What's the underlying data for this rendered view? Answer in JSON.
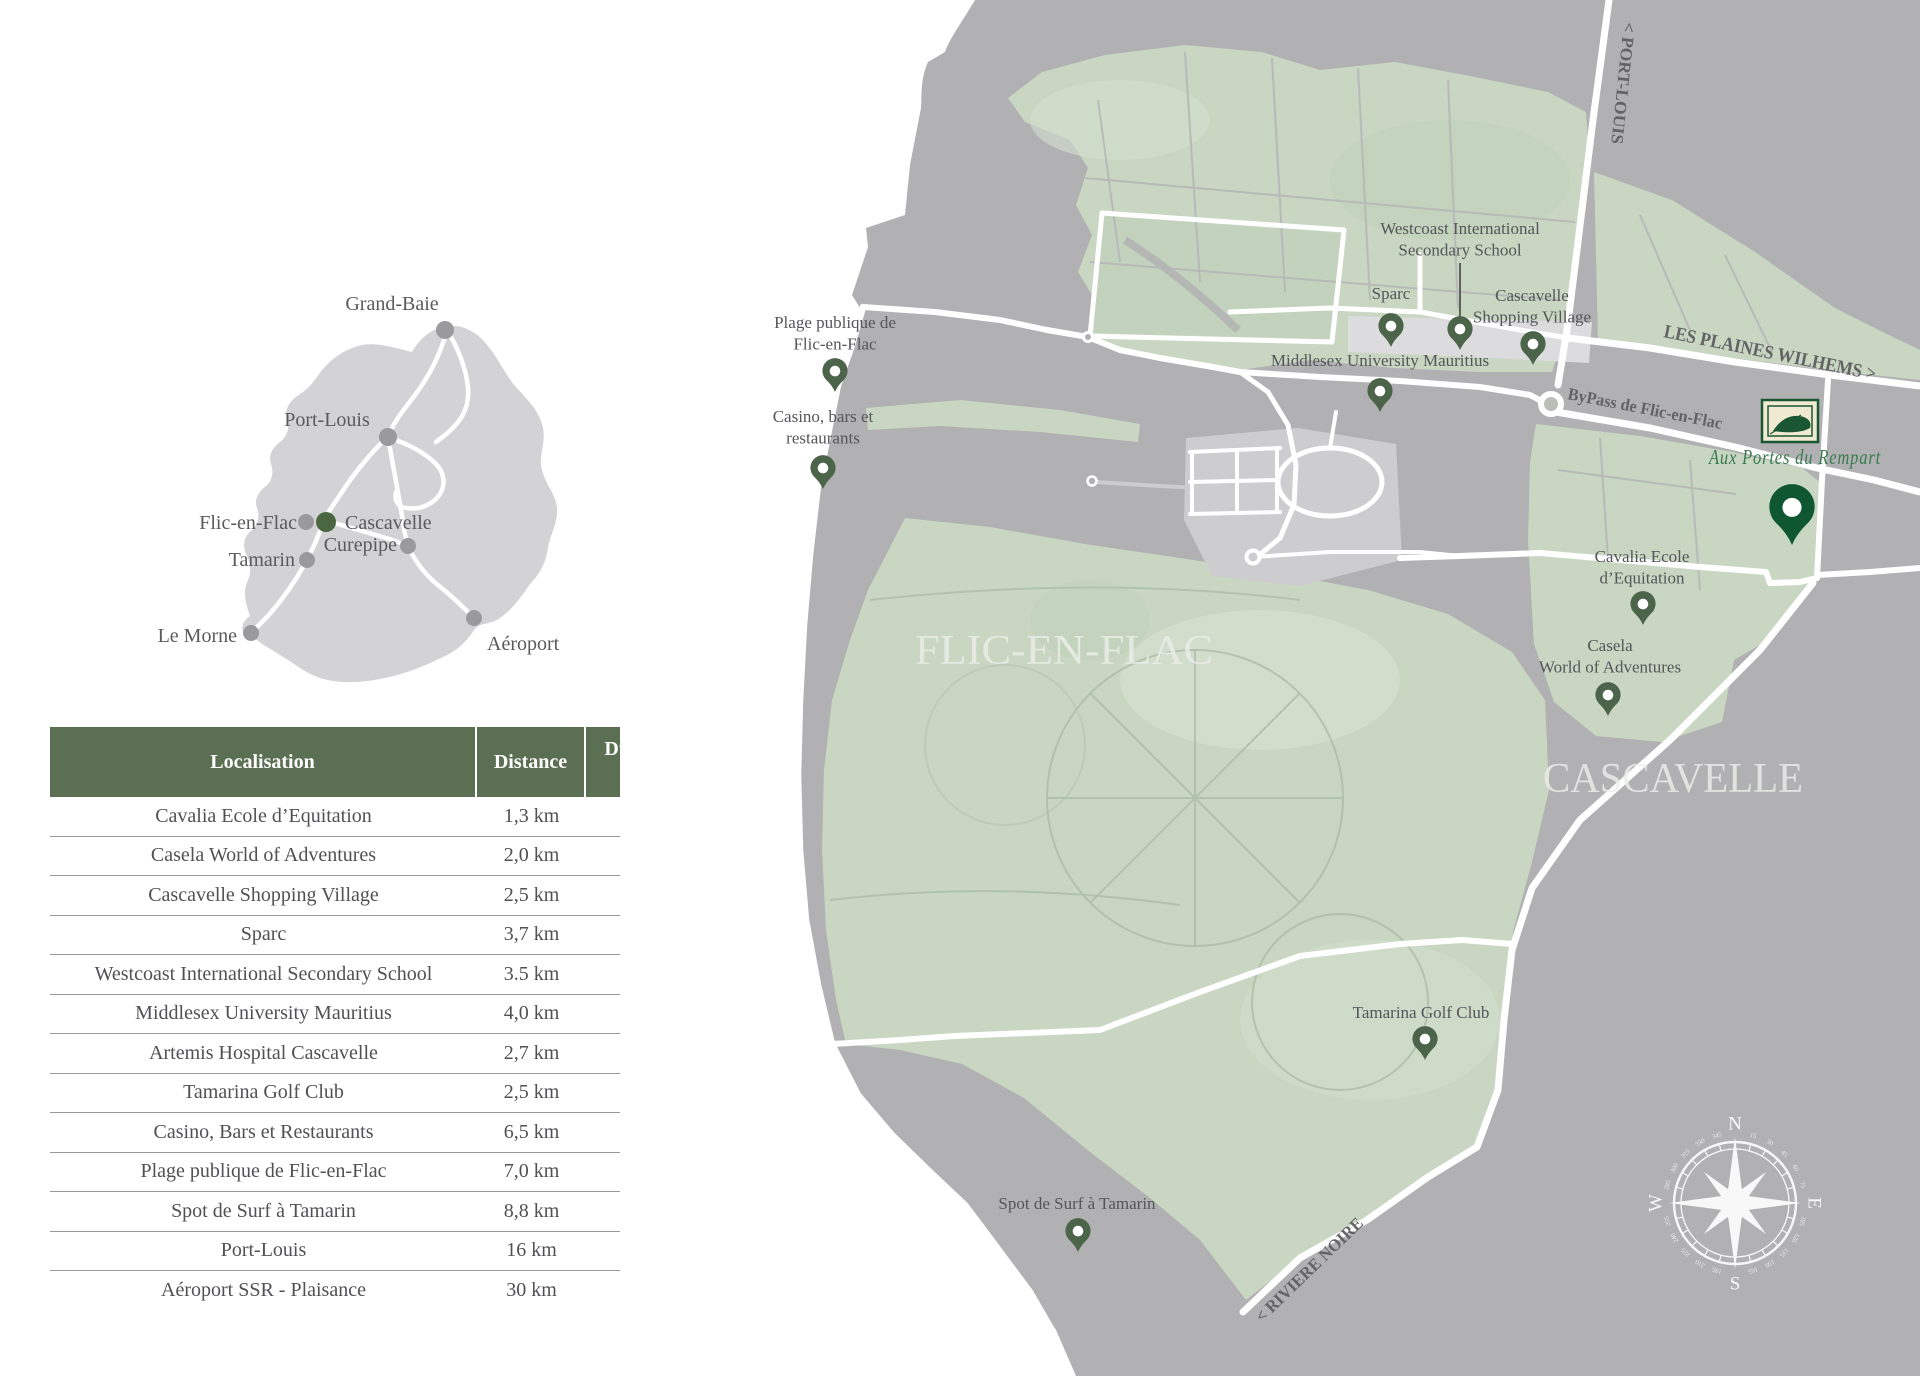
{
  "island_map": {
    "places": [
      {
        "id": "grand-baie",
        "name": "Grand-Baie",
        "label": [
          392,
          310
        ],
        "anchor": "middle",
        "dot": [
          445,
          330
        ],
        "dot_color": "#9a9a9c",
        "dot_r": 9
      },
      {
        "id": "port-louis",
        "name": "Port-Louis",
        "label": [
          327,
          426
        ],
        "anchor": "middle",
        "dot": [
          388,
          437
        ],
        "dot_color": "#9a9a9c",
        "dot_r": 9
      },
      {
        "id": "flic-en-flac",
        "name": "Flic-en-Flac",
        "label": [
          297,
          529
        ],
        "anchor": "end",
        "dot": [
          306,
          522
        ],
        "dot_color": "#9a9a9c",
        "dot_r": 8
      },
      {
        "id": "cascavelle",
        "name": "Cascavelle",
        "label": [
          345,
          529
        ],
        "anchor": "start",
        "dot": [
          326,
          522
        ],
        "dot_color": "#4a6741",
        "dot_r": 10
      },
      {
        "id": "curepipe",
        "name": "Curepipe",
        "label": [
          397,
          551
        ],
        "anchor": "end",
        "dot": [
          408,
          546
        ],
        "dot_color": "#9a9a9c",
        "dot_r": 8
      },
      {
        "id": "tamarin",
        "name": "Tamarin",
        "label": [
          295,
          566
        ],
        "anchor": "end",
        "dot": [
          307,
          560
        ],
        "dot_color": "#9a9a9c",
        "dot_r": 8
      },
      {
        "id": "le-morne",
        "name": "Le Morne",
        "label": [
          237,
          642
        ],
        "anchor": "end",
        "dot": [
          251,
          633
        ],
        "dot_color": "#9a9a9c",
        "dot_r": 8
      },
      {
        "id": "aeroport",
        "name": "Aéroport",
        "label": [
          487,
          650
        ],
        "anchor": "start",
        "dot": [
          474,
          618
        ],
        "dot_color": "#9a9a9c",
        "dot_r": 8
      }
    ]
  },
  "table": {
    "col_localisation": "Localisation",
    "col_distance": "Distance",
    "col_duration_line1": "Durée du trajet",
    "col_duration_line2": "(en voiture)",
    "rows": [
      {
        "loc": "Cavalia Ecole d’Equitation",
        "dist": "1,3 km",
        "time": "2 minutes"
      },
      {
        "loc": "Casela World of Adventures",
        "dist": "2,0 km",
        "time": "3 minutes"
      },
      {
        "loc": "Cascavelle Shopping Village",
        "dist": "2,5 km",
        "time": "4 minutes"
      },
      {
        "loc": "Sparc",
        "dist": "3,7 km",
        "time": "5 minutes"
      },
      {
        "loc": "Westcoast International Secondary School",
        "dist": "3.5 km",
        "time": "5 minutes"
      },
      {
        "loc": "Middlesex University Mauritius",
        "dist": "4,0 km",
        "time": "5 minutes"
      },
      {
        "loc": "Artemis Hospital Cascavelle",
        "dist": "2,7 km",
        "time": "4 minutes"
      },
      {
        "loc": "Tamarina Golf Club",
        "dist": "2,5 km",
        "time": "4 minutes"
      },
      {
        "loc": "Casino, Bars et Restaurants",
        "dist": "6,5 km",
        "time": "10 minutes"
      },
      {
        "loc": "Plage publique de Flic-en-Flac",
        "dist": "7,0 km",
        "time": "10 minutes"
      },
      {
        "loc": "Spot de Surf à Tamarin",
        "dist": "8,8 km",
        "time": "10 minutes"
      },
      {
        "loc": "Port-Louis",
        "dist": "16 km",
        "time": "20 minutes"
      },
      {
        "loc": "Aéroport SSR - Plaisance",
        "dist": "30 km",
        "time": "40 minutes"
      }
    ]
  },
  "detail_map": {
    "area_labels": [
      {
        "id": "flic-en-flac-area",
        "text": "FLIC-EN-FLAC",
        "x": 1064,
        "y": 664,
        "size": 42,
        "length": 298
      },
      {
        "id": "cascavelle-area",
        "text": "CASCAVELLE",
        "x": 1673,
        "y": 792,
        "size": 42,
        "length": 260
      }
    ],
    "road_labels": [
      {
        "id": "port-louis-road",
        "text": "< PORT-LOUIS",
        "x": 1624,
        "y": 22,
        "rotate": 96,
        "size": 17,
        "length": 122
      },
      {
        "id": "les-plaines-wilhems-road",
        "text": "LES PLAINES WILHEMS >",
        "x": 1663,
        "y": 337,
        "rotate": 11.5,
        "size": 19,
        "length": 216
      },
      {
        "id": "bypass-road",
        "text": "ByPass de Flic-en-Flac",
        "x": 1567,
        "y": 399,
        "rotate": 11,
        "size": 17,
        "length": 157
      },
      {
        "id": "riviere-noire-road",
        "text": "< RIVIERE NOIRE",
        "x": 1262,
        "y": 1323,
        "rotate": -44,
        "size": 17,
        "length": 142
      }
    ],
    "pois": [
      {
        "id": "plage-publique",
        "lines": [
          "Plage publique de",
          "Flic-en-Flac"
        ],
        "label_x": 835,
        "label_y": 328,
        "pin_x": 835,
        "pin_y": 392,
        "scale": 1
      },
      {
        "id": "casino-bars",
        "lines": [
          "Casino, bars et",
          "restaurants"
        ],
        "label_x": 823,
        "label_y": 422,
        "pin_x": 823,
        "pin_y": 489,
        "scale": 1
      },
      {
        "id": "sparc",
        "lines": [
          "Sparc"
        ],
        "label_x": 1391,
        "label_y": 299,
        "pin_x": 1391,
        "pin_y": 347,
        "scale": 1
      },
      {
        "id": "westcoast-school",
        "lines": [
          "Westcoast International",
          "Secondary School"
        ],
        "label_x": 1460,
        "label_y": 234,
        "pin_x": 1460,
        "pin_y": 350,
        "scale": 1,
        "leader": [
          1460,
          263,
          1460,
          318
        ]
      },
      {
        "id": "cascavelle-shopping",
        "lines": [
          "Cascavelle",
          "Shopping Village"
        ],
        "label_x": 1532,
        "label_y": 301,
        "pin_x": 1533,
        "pin_y": 365,
        "scale": 1
      },
      {
        "id": "middlesex-university",
        "lines": [
          "Middlesex University Mauritius"
        ],
        "label_x": 1380,
        "label_y": 366,
        "pin_x": 1380,
        "pin_y": 412,
        "scale": 1
      },
      {
        "id": "cavalia",
        "lines": [
          "Cavalia Ecole",
          "d’Equitation"
        ],
        "label_x": 1642,
        "label_y": 562,
        "pin_x": 1643,
        "pin_y": 625,
        "scale": 1
      },
      {
        "id": "casela",
        "lines": [
          "Casela",
          "World of Adventures"
        ],
        "label_x": 1610,
        "label_y": 651,
        "pin_x": 1608,
        "pin_y": 716,
        "scale": 1
      },
      {
        "id": "tamarina-golf",
        "lines": [
          "Tamarina Golf Club"
        ],
        "label_x": 1421,
        "label_y": 1018,
        "pin_x": 1425,
        "pin_y": 1060,
        "scale": 1
      },
      {
        "id": "spot-surf",
        "lines": [
          "Spot de Surf à Tamarin"
        ],
        "label_x": 1077,
        "label_y": 1209,
        "pin_x": 1078,
        "pin_y": 1252,
        "scale": 1
      },
      {
        "id": "project",
        "lines": [],
        "label_x": 0,
        "label_y": 0,
        "pin_x": 1792,
        "pin_y": 545,
        "scale": 1.8,
        "pin_color": "#0f5731"
      }
    ],
    "project_logo": {
      "name": "Aux Portes du Rempart",
      "x": 1795,
      "y": 464
    },
    "compass": {
      "cx": 1735,
      "cy": 1203,
      "letters": [
        {
          "t": "N",
          "a": 0
        },
        {
          "t": "E",
          "a": 90
        },
        {
          "t": "S",
          "a": 180
        },
        {
          "t": "W",
          "a": 270
        }
      ],
      "degrees": [
        15,
        30,
        45,
        60,
        75,
        105,
        120,
        135,
        150,
        165,
        195,
        210,
        225,
        240,
        255,
        285,
        300,
        315,
        330,
        345
      ]
    }
  },
  "colors": {
    "pin_green": "#4c654a",
    "project_green": "#0f5731",
    "header_green": "#5b7053",
    "land_gray": "#b1b1b3",
    "zone_green": "#c8d6c2",
    "island_gray": "#d3d3d5",
    "logo_cream": "#f0ead3",
    "script_green": "#3a7a50"
  }
}
